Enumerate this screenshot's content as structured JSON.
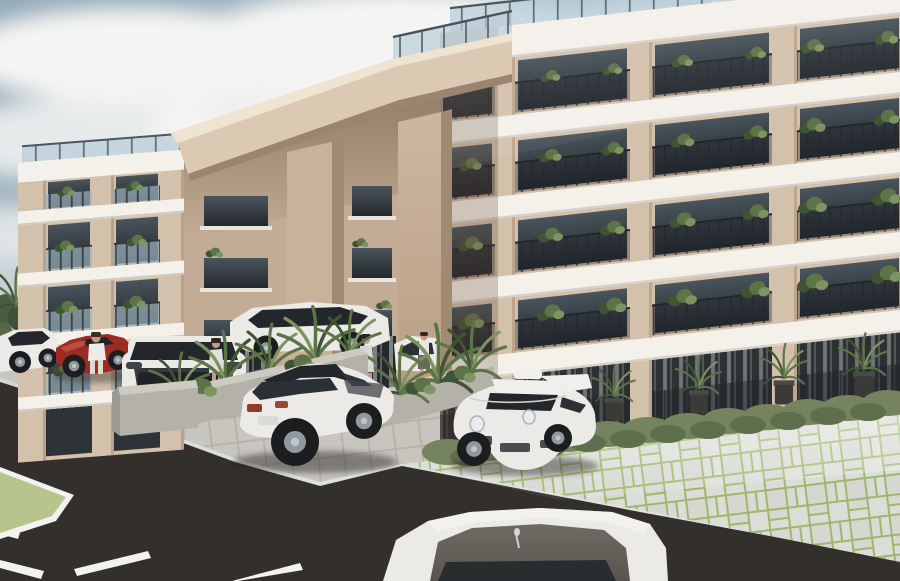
{
  "scene": {
    "type": "architectural-rendering",
    "description": "Exterior 3D rendering of a four-storey beige condominium building with white balcony slabs, dark-framed glass balconies with potted plants, a large entrance canopy on square columns, rooftop glass railings, palm landscaping in concrete planters, luxury cars parked on grass-jointed pavers beside a dark asphalt road under a cloudy sky",
    "objects": {
      "sky": "overcast sky with soft white clouds",
      "building": "4-storey beige residential block, perspective from left",
      "canopy": "large flat entrance canopy slab on two square columns",
      "roof_railing": "frameless glass railing along rooftop edges",
      "balconies": "stacked balconies with dark metal railings and plants",
      "ground_floor": "full-height glazed storefronts with white curtains and shrub hedge",
      "planters": "raised concrete planters with palms near entrance",
      "cars": [
        "white sports car far left",
        "red roadster",
        "white SUV front view",
        "white estate by entrance",
        "white coupe with dark glass roof",
        "white 911-style sports car",
        "white luxury car hood in foreground"
      ],
      "people": [
        "man in white suit walking",
        "woman near parked SUV",
        "woman by entrance",
        "woman by entrance planter"
      ],
      "road": "dark asphalt drive with white lane markings and grass island",
      "paving": "light pavers with green grass joints"
    },
    "counts": {
      "balcony_floors": 4,
      "canopy_columns": 2,
      "visible_cars": 7,
      "people": 4
    }
  },
  "colors": {
    "sky_top": "#9db1bf",
    "sky_mid": "#c7d1d6",
    "sky_horizon": "#e7e9e7",
    "cloud": "#f5f5f3",
    "wall": "#d4c1ac",
    "wall_recessed": "#c2ac95",
    "fascia": "#f4f1eb",
    "canopy_face": "#dcc9b3",
    "canopy_top": "#efe3d2",
    "canopy_under": "#9c8570",
    "column": "#c9b29a",
    "column_side": "#a18a72",
    "glass_top": "#4a545c",
    "glass_bottom": "#23282c",
    "railing_glass": "#b9cdd8",
    "balcony_glass": "#9db3bf",
    "plant": "#5d7348",
    "plant_dark": "#3f5433",
    "plant_light": "#7d9460",
    "hedge": "#75835e",
    "hedge_dark": "#5f6e4d",
    "pot": "#3b3a37",
    "concrete": "#b4b1a9",
    "concrete_top": "#cdcac2",
    "asphalt": "#332f2c",
    "paver_block": "#dcddd7",
    "paver_joint": "#9cb86e",
    "paver_strip": "#c7c5be",
    "walkway": "#d6d3cb",
    "marking": "#f2f2ee",
    "grass": "#b7c48d",
    "car_white": "#eceae6",
    "car_red": "#9e2b21",
    "car_glass": "#23272b",
    "rolls_hood": "#6f6a63",
    "tire": "#1b1d1f",
    "rim": "#9099a0",
    "skin": "#c69a7e",
    "shadow": "#26221f"
  }
}
